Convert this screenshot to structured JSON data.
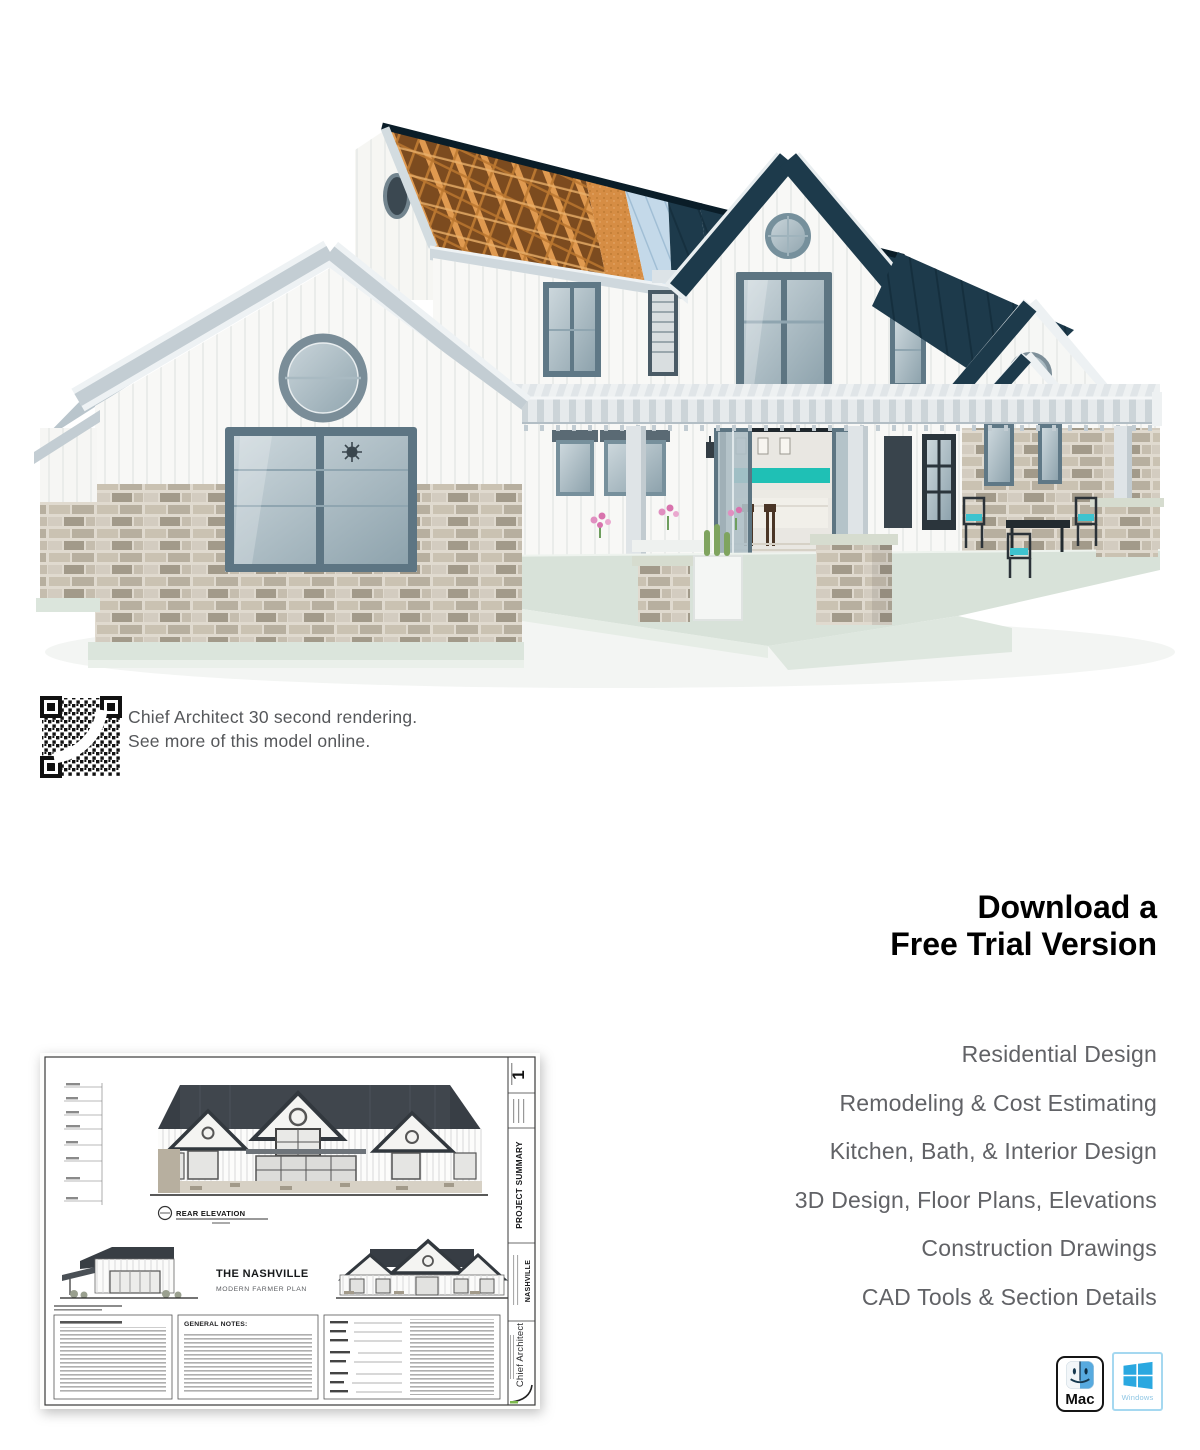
{
  "hero": {
    "description": "3D rendering of a modern farmhouse showing construction phases: exposed roof trusses, sheathing, underlayment and finished dark metal roof, white board-and-batten siding, stone wainscot, wraparound pergola porch",
    "colors": {
      "roof_navy": "#1d3a4b",
      "truss_orange": "#d8924a",
      "underlayment_blue": "#c4d9e9",
      "siding_white": "#f8f8f6",
      "window_frame": "#5d7583",
      "stone": "#cfc8ba",
      "porch_slab": "#d8e2d9",
      "kitchen_teal": "#1fc0b5"
    }
  },
  "qr_section": {
    "icon": "qr-code",
    "line1": "Chief Architect 30 second rendering.",
    "line2": "See more of this model online."
  },
  "cta": {
    "heading_line1": "Download a",
    "heading_line2": "Free Trial Version",
    "heading_color": "#717276",
    "features": [
      "Residential Design",
      "Remodeling & Cost Estimating",
      "Kitchen, Bath, & Interior Design",
      "3D Design, Floor Plans, Elevations",
      "Construction Drawings",
      "CAD Tools & Section Details"
    ]
  },
  "blueprint": {
    "sheet_number": "1",
    "elevation_label": "REAR ELEVATION",
    "plan_title": "THE NASHVILLE",
    "plan_subtitle": "MODERN FARMER PLAN",
    "notes_heading": "GENERAL NOTES:",
    "titleblock_project_summary": "PROJECT SUMMARY",
    "titleblock_plan_name": "NASHVILLE",
    "titleblock_brand": "Chief Architect"
  },
  "platforms": {
    "mac": {
      "icon": "finder-face-icon",
      "label": "Mac"
    },
    "windows": {
      "icon": "windows-logo-icon",
      "label": "Windows",
      "logo_color": "#2aa8e0"
    }
  }
}
